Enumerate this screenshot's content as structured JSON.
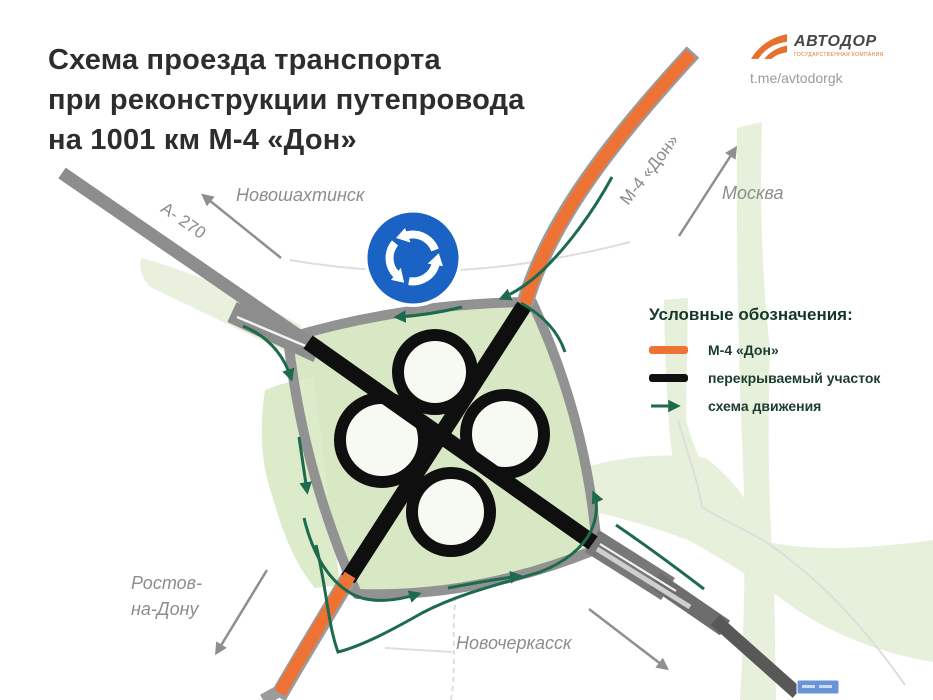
{
  "title": {
    "lines": [
      "Схема проезда транспорта",
      "при реконструкции путепровода",
      "на 1001 км М-4 «Дон»"
    ]
  },
  "brand": {
    "name": "АВТОДОР",
    "subtitle": "ГОСУДАРСТВЕННАЯ КОМПАНИЯ",
    "telegram": "t.me/avtodorgk"
  },
  "legend": {
    "title": "Условные обозначения:",
    "items": [
      {
        "id": "m4",
        "label": "М-4 «Дон»",
        "swatch": "orange-line",
        "color": "#ee7233"
      },
      {
        "id": "closed",
        "label": "перекрываемый участок",
        "swatch": "black-line",
        "color": "#101010"
      },
      {
        "id": "movement",
        "label": "схема движения",
        "swatch": "green-arrow",
        "color": "#1d6a4d"
      }
    ]
  },
  "map": {
    "labels": {
      "novoshakhtinsk": "Новошахтинск",
      "moscow": "Москва",
      "rostov": [
        "Ростов-",
        "на-Дону"
      ],
      "novocherkassk": "Новочеркасск",
      "a270": "А- 270",
      "m4": "М-4 «Дон»"
    },
    "signs": {
      "roundabout": "roundabout-sign"
    }
  },
  "colors": {
    "m4_orange": "#ee7233",
    "closed_black": "#101010",
    "movement_green": "#1d6a4d",
    "road_gray": "#8d8d8d",
    "map_green": "#e6f0da",
    "interchange_green": "#d8e8c4",
    "roundabout_blue": "#1a63c4",
    "label_gray": "#8d8d8d",
    "title_dark": "#2d2d2d"
  }
}
